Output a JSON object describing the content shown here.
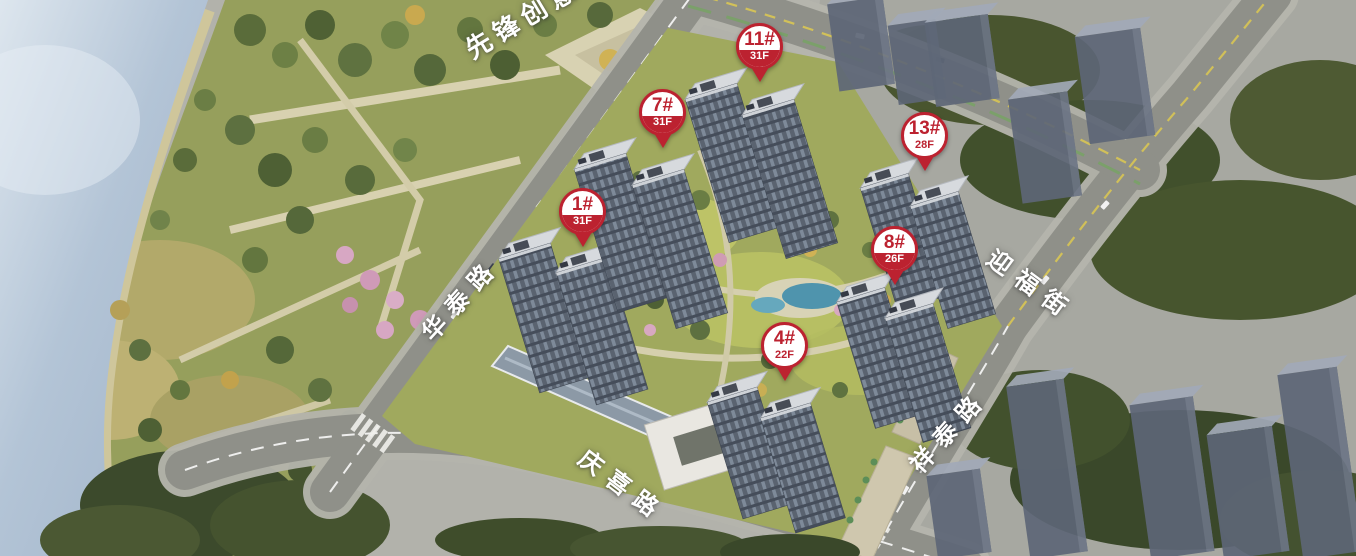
{
  "pins": [
    {
      "label": "1#",
      "floors": "31F"
    },
    {
      "label": "7#",
      "floors": "31F"
    },
    {
      "label": "11#",
      "floors": "31F"
    },
    {
      "label": "13#",
      "floors": "28F"
    },
    {
      "label": "8#",
      "floors": "26F"
    },
    {
      "label": "4#",
      "floors": "22F"
    }
  ],
  "road_labels": {
    "huatai": "华泰路",
    "qingxi": "庆喜路",
    "xiangtai": "祥泰路",
    "yingfu": "迎福街"
  },
  "area_labels": {
    "park": "先锋创意"
  },
  "colors": {
    "pin_red": "#bc2230",
    "water_blue": "#b3c4d6",
    "park_green": "#969f5c",
    "road_gray": "#8f9089",
    "tower_roof": "#d6d9dd",
    "tower_facade": "#5a6370"
  }
}
